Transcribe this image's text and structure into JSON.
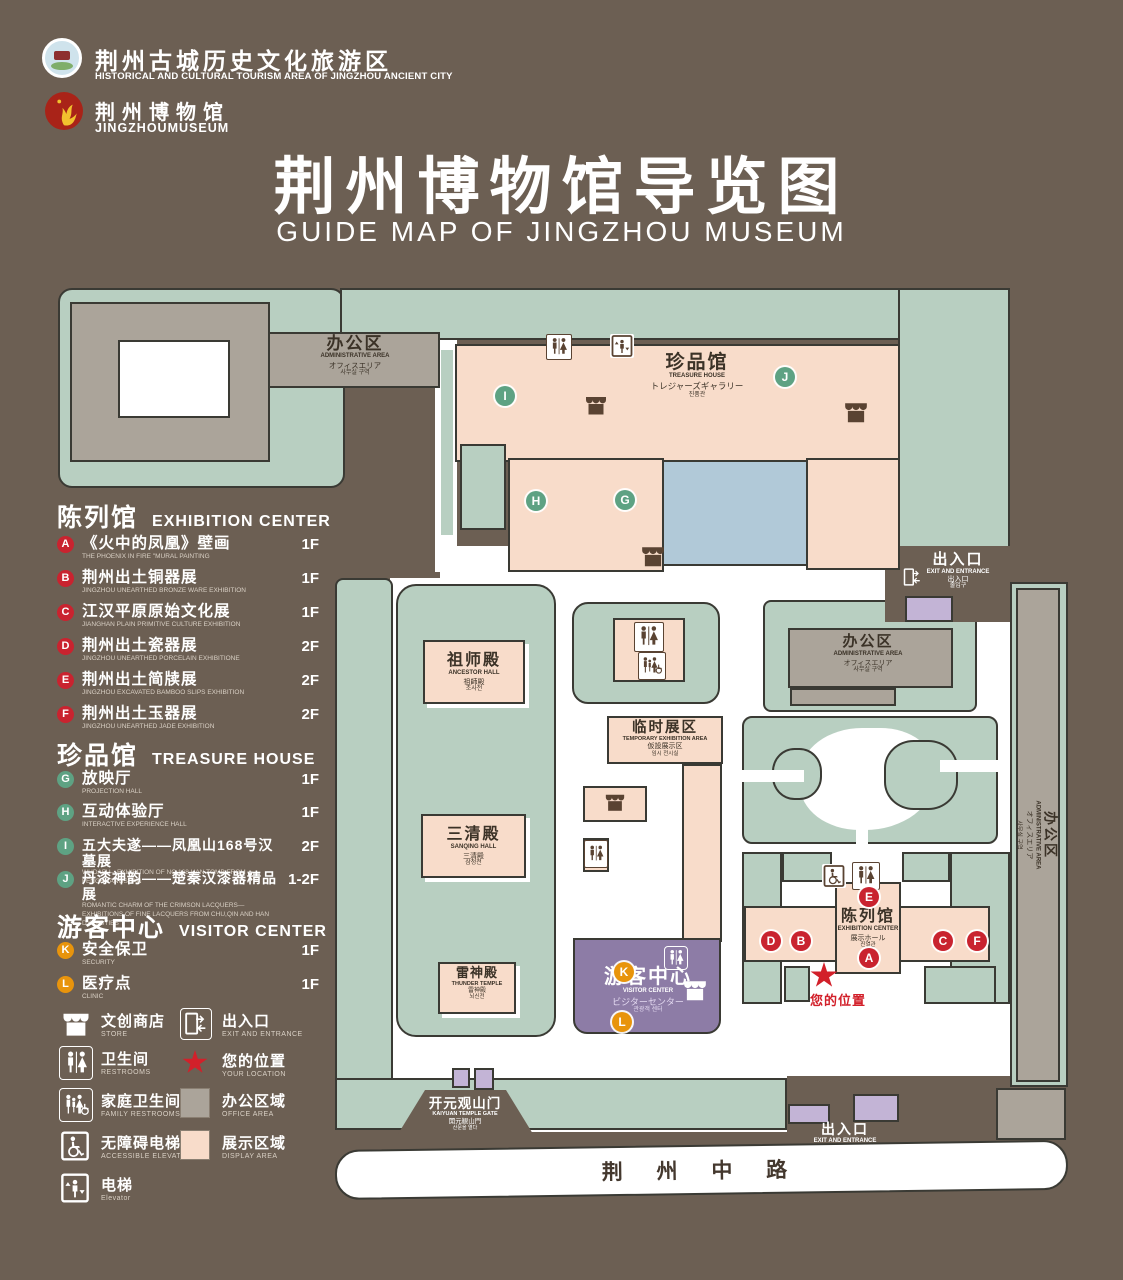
{
  "header": {
    "org_zh": "荆州古城历史文化旅游区",
    "org_en": "HISTORICAL AND CULTURAL TOURISM AREA OF JINGZHOU ANCIENT CITY",
    "museum_zh": "荆州博物馆",
    "museum_en": "JINGZHOUMUSEUM",
    "title_zh": "荆州博物馆导览图",
    "title_en": "GUIDE MAP OF JINGZHOU MUSEUM"
  },
  "legend": {
    "exhibition": {
      "zh": "陈列馆",
      "en": "EXHIBITION CENTER",
      "items": [
        {
          "letter": "A",
          "zh": "《火中的凤凰》壁画",
          "en": "THE PHOENIX IN FIRE \"MURAL PAINTING",
          "floor": "1F"
        },
        {
          "letter": "B",
          "zh": "荆州出土铜器展",
          "en": "JINGZHOU UNEARTHED BRONZE WARE EXHIBITION",
          "floor": "1F"
        },
        {
          "letter": "C",
          "zh": "江汉平原原始文化展",
          "en": "JIANGHAN PLAIN PRIMITIVE CULTURE EXHIBITION",
          "floor": "1F"
        },
        {
          "letter": "D",
          "zh": "荆州出土瓷器展",
          "en": "JINGZHOU UNEARTHED PORCELAIN EXHIBITIONE",
          "floor": "2F"
        },
        {
          "letter": "E",
          "zh": "荆州出土简牍展",
          "en": "JINGZHOU EXCAVATED BAMBOO SLIPS EXHIBITION",
          "floor": "2F"
        },
        {
          "letter": "F",
          "zh": "荆州出土玉器展",
          "en": "JINGZHOU UNEARTHED JADE EXHIBITION",
          "floor": "2F"
        }
      ]
    },
    "treasure": {
      "zh": "珍品馆",
      "en": "TREASURE HOUSE",
      "items": [
        {
          "letter": "G",
          "zh": "放映厅",
          "en": "PROJECTION HALL",
          "floor": "1F"
        },
        {
          "letter": "H",
          "zh": "互动体验厅",
          "en": "INTERACTIVE EXPERIENCE HALL",
          "floor": "1F"
        },
        {
          "letter": "I",
          "zh": "五大夫遂——凤凰山168号汉墓展",
          "en": "WUDAFU—EXHIBITION OF NO.168 HAN TOMB FROM FENGHUANGSHAN",
          "floor": "2F"
        },
        {
          "letter": "J",
          "zh": "丹漆神韵——楚秦汉漆器精品展",
          "en": "ROMANTIC CHARM OF THE CRIMSON LACQUERS—EXHIBITIONS OF FINE LACQUERS FROM CHU,QIN AND HAN DYNASTIES",
          "floor": "1-2F"
        }
      ]
    },
    "visitor": {
      "zh": "游客中心",
      "en": "VISITOR CENTER",
      "items": [
        {
          "letter": "K",
          "zh": "安全保卫",
          "en": "SECURITY",
          "floor": "1F"
        },
        {
          "letter": "L",
          "zh": "医疗点",
          "en": "CLINIC",
          "floor": "1F"
        }
      ]
    },
    "icons": {
      "store": {
        "zh": "文创商店",
        "en": "STORE"
      },
      "exit": {
        "zh": "出入口",
        "en": "EXIT AND ENTRANCE"
      },
      "restrooms": {
        "zh": "卫生间",
        "en": "RESTROOMS"
      },
      "location": {
        "zh": "您的位置",
        "en": "YOUR LOCATION"
      },
      "family": {
        "zh": "家庭卫生间",
        "en": "FAMILY RESTROOMS"
      },
      "office": {
        "zh": "办公区域",
        "en": "OFFICE AREA"
      },
      "accessible": {
        "zh": "无障碍电梯",
        "en": "ACCESSIBLE ELEVATOR"
      },
      "display": {
        "zh": "展示区域",
        "en": "DISPLAY AREA"
      },
      "elevator": {
        "zh": "电梯",
        "en": "Elevator"
      }
    }
  },
  "map": {
    "labels": {
      "admin_nw": {
        "zh": "办公区",
        "en": "ADMINISTRATIVE AREA",
        "ja": "オフィスエリア",
        "ko": "사무실 구역"
      },
      "treasure": {
        "zh": "珍品馆",
        "en": "TREASURE HOUSE",
        "ja": "トレジャーズギャラリー",
        "ko": "진품관"
      },
      "admin_e": {
        "zh": "办公区",
        "en": "ADMINISTRATIVE AREA",
        "ja": "オフィスエリア",
        "ko": "사무실 구역"
      },
      "admin_strip": {
        "zh": "办公区",
        "en": "ADMINISTRATIVE AREA",
        "ja": "オフィスエリア",
        "ko": "사무실 구역"
      },
      "ancestor": {
        "zh": "祖师殿",
        "en": "ANCESTOR HALL",
        "ja": "祖師殿",
        "ko": "조사전"
      },
      "sanqing": {
        "zh": "三清殿",
        "en": "SANQING HALL",
        "ja": "三清殿",
        "ko": "삼청전"
      },
      "thunder": {
        "zh": "雷神殿",
        "en": "THUNDER TEMPLE",
        "ja": "雷神殿",
        "ko": "뇌신전"
      },
      "temp": {
        "zh": "临时展区",
        "en": "TEMPORARY EXHIBITION AREA",
        "ja": "仮設展示区",
        "ko": "임시 전시실"
      },
      "visitor": {
        "zh": "游客中心",
        "en": "VISITOR CENTER",
        "ja": "ビジターセンター",
        "ko": "관광객 센터"
      },
      "exhibition": {
        "zh": "陈列馆",
        "en": "EXHIBITION CENTER",
        "ja": "展示ホール",
        "ko": "진열관"
      },
      "gate": {
        "zh": "开元观山门",
        "en": "KAIYUAN TEMPLE GATE",
        "ja": "開元観山門",
        "ko": "산문을 열다"
      },
      "exit_ne": {
        "zh": "出入口",
        "en": "EXIT AND ENTRANCE",
        "ja": "出入口",
        "ko": "출입구"
      },
      "exit_s": {
        "zh": "出入口",
        "en": "EXIT AND ENTRANCE",
        "ja": "出入口",
        "ko": "출입구"
      },
      "road": {
        "zh": "荆 州 中 路"
      },
      "your_location": {
        "zh": "您的位置"
      }
    },
    "markers": {
      "A": "A",
      "B": "B",
      "C": "C",
      "D": "D",
      "E": "E",
      "F": "F",
      "G": "G",
      "H": "H",
      "I": "I",
      "J": "J",
      "K": "K",
      "L": "L"
    }
  },
  "colors": {
    "background": "#6c5f53",
    "lawn": "#b8cfc1",
    "display_area": "#f8dcca",
    "office_area": "#aba49a",
    "water": "#b1c9d8",
    "visitor_center": "#8d7ca6",
    "entrance_purple": "#c3b4d6",
    "marker_red": "#c9232f",
    "marker_green": "#5ea283",
    "marker_orange": "#e8940c",
    "icon_brown": "#5a4332",
    "location_red": "#d2202a"
  }
}
